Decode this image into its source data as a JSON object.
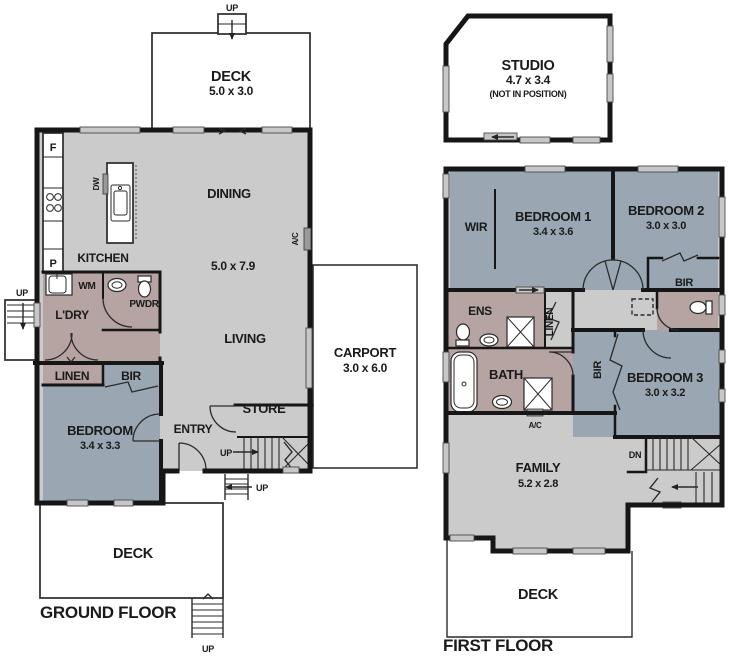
{
  "title": "Two storey house floor plan",
  "colors": {
    "wall": "#161616",
    "floor": "#cbcbcb",
    "bedroom": "#9aa7b2",
    "wet": "#b6a4a2",
    "win": "#c7c7c7"
  },
  "labels": {
    "up": "UP",
    "dn": "DN",
    "ac": "A/C",
    "linen": "LINEN",
    "bir": "BIR",
    "wir": "WIR"
  },
  "ground_floor": {
    "floor_label": "GROUND FLOOR",
    "deck_top": {
      "name": "DECK",
      "dims": "5.0 x 3.0"
    },
    "kitchen": "KITCHEN",
    "fridge": "F",
    "pantry": "P",
    "dishwasher": "DW",
    "washing_machine": "WM",
    "dining": "DINING",
    "living": "LIVING",
    "living_dining_dims": "5.0 x 7.9",
    "laundry": "L'DRY",
    "powder": "PWDR",
    "bedroom": {
      "name": "BEDROOM",
      "dims": "3.4 x 3.3"
    },
    "entry": "ENTRY",
    "store": "STORE",
    "carport": {
      "name": "CARPORT",
      "dims": "3.0 x 6.0"
    },
    "deck_bottom": "DECK"
  },
  "first_floor": {
    "floor_label": "FIRST FLOOR",
    "studio": {
      "name": "STUDIO",
      "dims": "4.7 x 3.4",
      "note": "(NOT IN POSITION)"
    },
    "bedroom1": {
      "name": "BEDROOM 1",
      "dims": "3.4 x 3.6"
    },
    "bedroom2": {
      "name": "BEDROOM 2",
      "dims": "3.0 x 3.0"
    },
    "bedroom3": {
      "name": "BEDROOM 3",
      "dims": "3.0 x 3.2"
    },
    "ens": "ENS",
    "bath": "BATH",
    "family": {
      "name": "FAMILY",
      "dims": "5.2 x 2.8"
    },
    "deck": "DECK"
  }
}
